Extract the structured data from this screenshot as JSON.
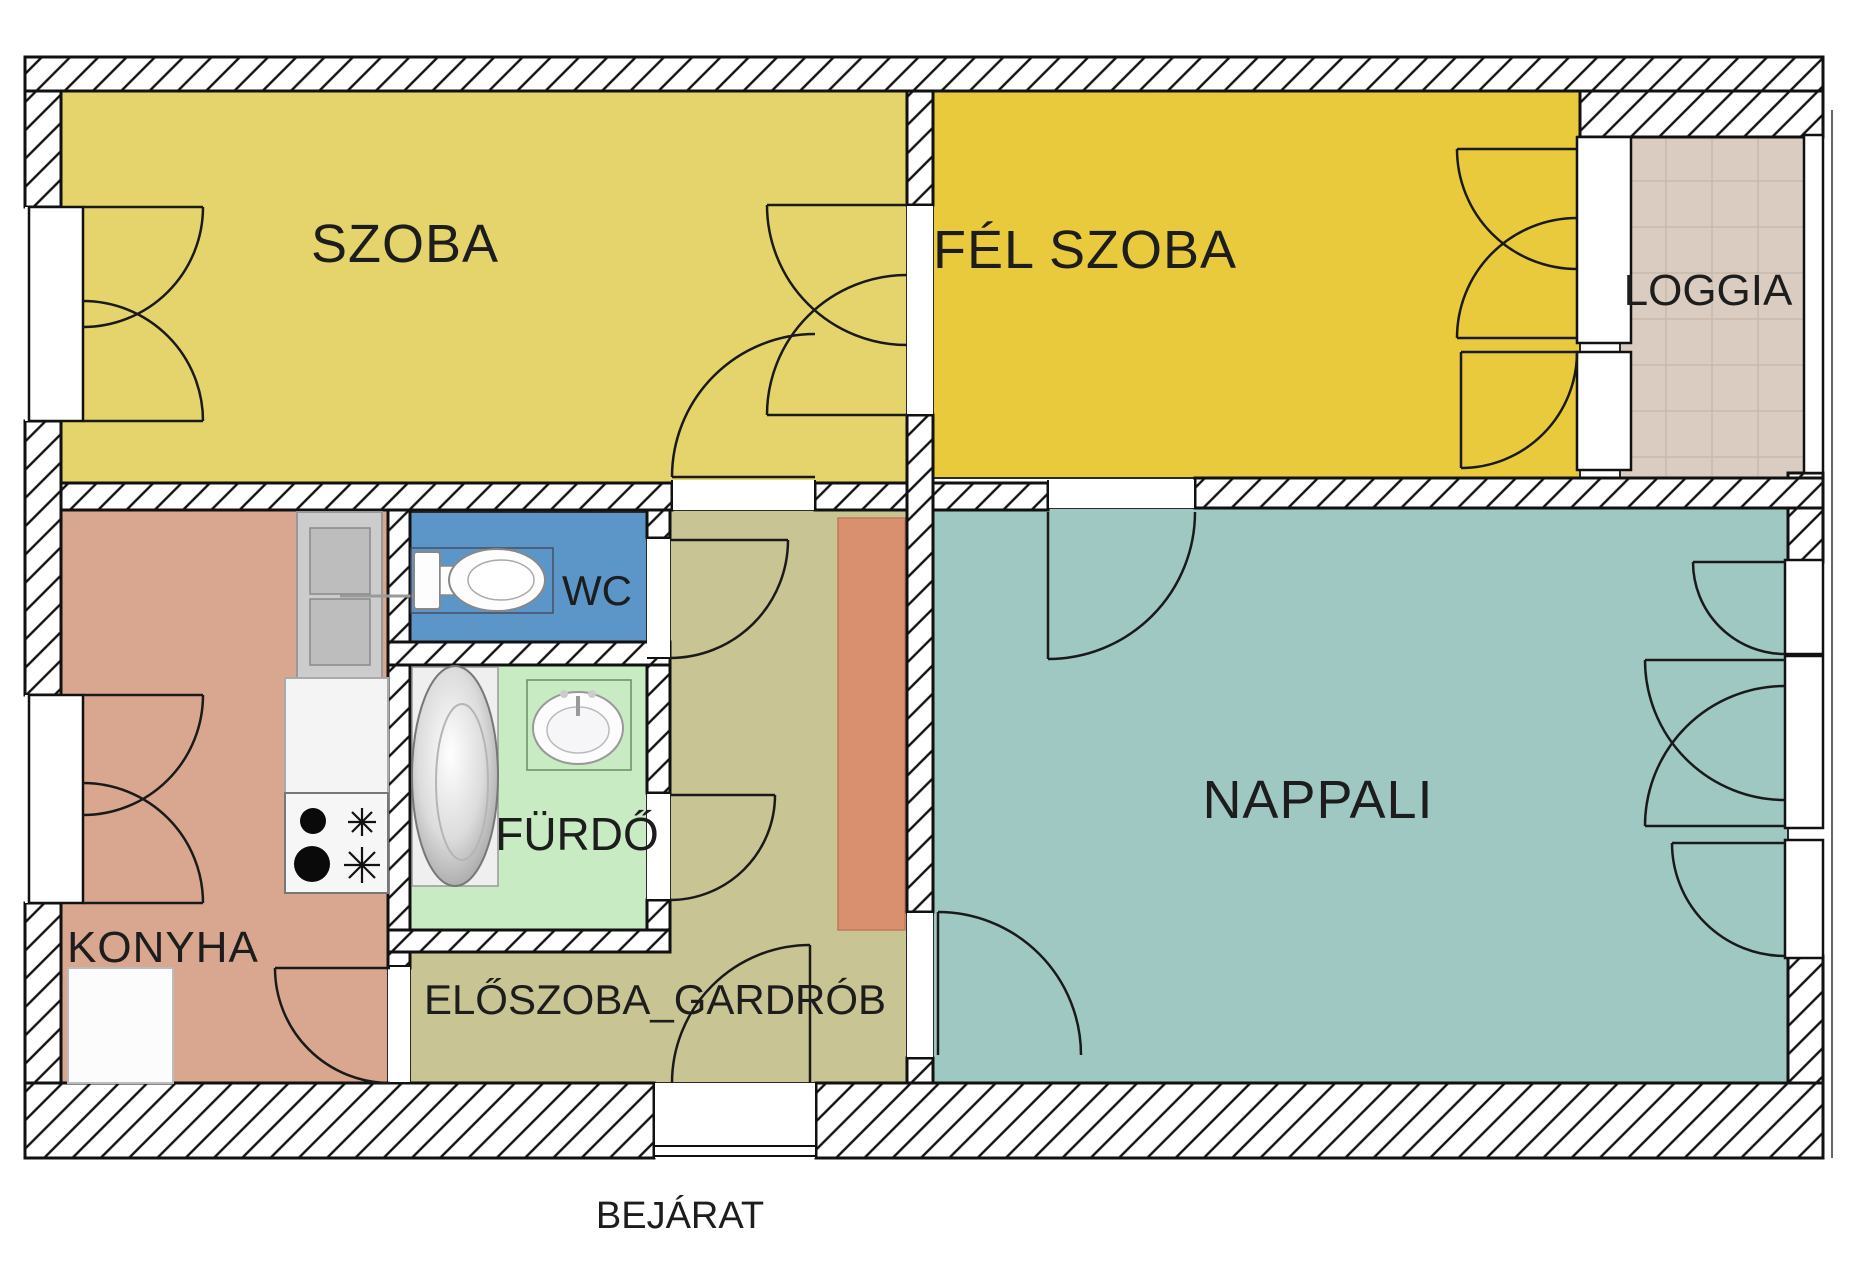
{
  "plan": {
    "type": "apartment-floor-plan",
    "background": "#ffffff",
    "wall_hatch_color": "#111111"
  },
  "rooms": {
    "szoba": {
      "label": "SZOBA",
      "color": "#e5d46c"
    },
    "fel_szoba": {
      "label": "FÉL SZOBA",
      "color": "#e8ca3c"
    },
    "loggia": {
      "label": "LOGGIA",
      "color": "#daccc0"
    },
    "nappali": {
      "label": "NAPPALI",
      "color": "#9fc8c3"
    },
    "konyha": {
      "label": "KONYHA",
      "color": "#d9a78f"
    },
    "eloszoba": {
      "label": "ELŐSZOBA_GARDRÓB",
      "color": "#c9c493"
    },
    "wc": {
      "label": "WC",
      "color": "#5c96c9"
    },
    "furdo": {
      "label": "FÜRDŐ",
      "color": "#c9ebc3"
    }
  },
  "entrance": {
    "label": "BEJÁRAT"
  },
  "furniture": {
    "wardrobe_block_color": "#d9906f",
    "fixtures": [
      "fridge-icon",
      "kitchen-counter",
      "stove-icon",
      "toilet-icon",
      "bathtub-icon",
      "sink-icon",
      "cabinet-block"
    ]
  }
}
